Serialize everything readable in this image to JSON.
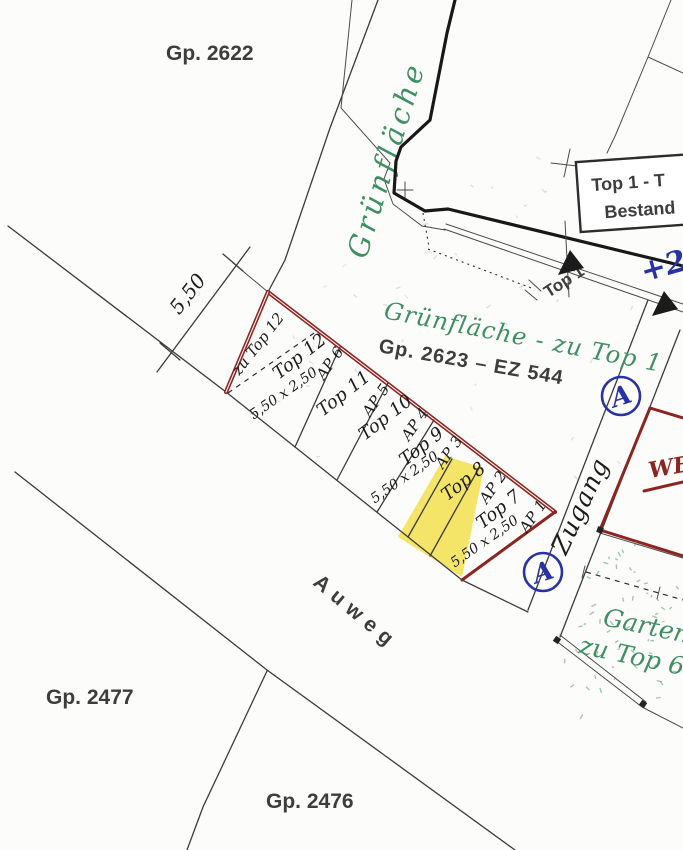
{
  "parcels": {
    "gp2622": "Gp.  2622",
    "gp2477": "Gp.  2477",
    "gp2476": "Gp.  2476",
    "gp2623": "Gp.  2623 – EZ 544"
  },
  "green": {
    "band": "Grünfläche",
    "zu_top1": "Grünfläche - zu Top 1",
    "garten_line1": "Garten",
    "garten_line2": "zu Top 6"
  },
  "street": {
    "name": "Auweg"
  },
  "walkway": {
    "label": "Zugang"
  },
  "top1_box": {
    "line1": "Top 1  - T",
    "line2": "Bestand"
  },
  "pointer": {
    "top1": "Top 1"
  },
  "we_label": "WE",
  "blue": {
    "circle_a": "A",
    "annotation": "+23"
  },
  "dimensions": {
    "depth": "5,50",
    "spot_size": "5,50 x 2,50"
  },
  "parking": {
    "zu_label": "zu Top 12",
    "spots": [
      {
        "top": "Top 12",
        "ap": "AP 6",
        "highlighted": false
      },
      {
        "top": "Top 11",
        "ap": "AP 5",
        "highlighted": false
      },
      {
        "top": "Top 10",
        "ap": "AP 4",
        "highlighted": false
      },
      {
        "top": "Top 9",
        "ap": "AP 3",
        "highlighted": false
      },
      {
        "top": "Top 8",
        "ap": "AP 2",
        "highlighted": true
      },
      {
        "top": "Top 7",
        "ap": "AP 1",
        "highlighted": false
      }
    ]
  },
  "colors": {
    "red_outline": "#8c2420",
    "green_ink": "#3f8f63",
    "blue_ink": "#2733a5",
    "highlight_yellow": "#f2df4e",
    "ink": "#1c1c1c"
  }
}
